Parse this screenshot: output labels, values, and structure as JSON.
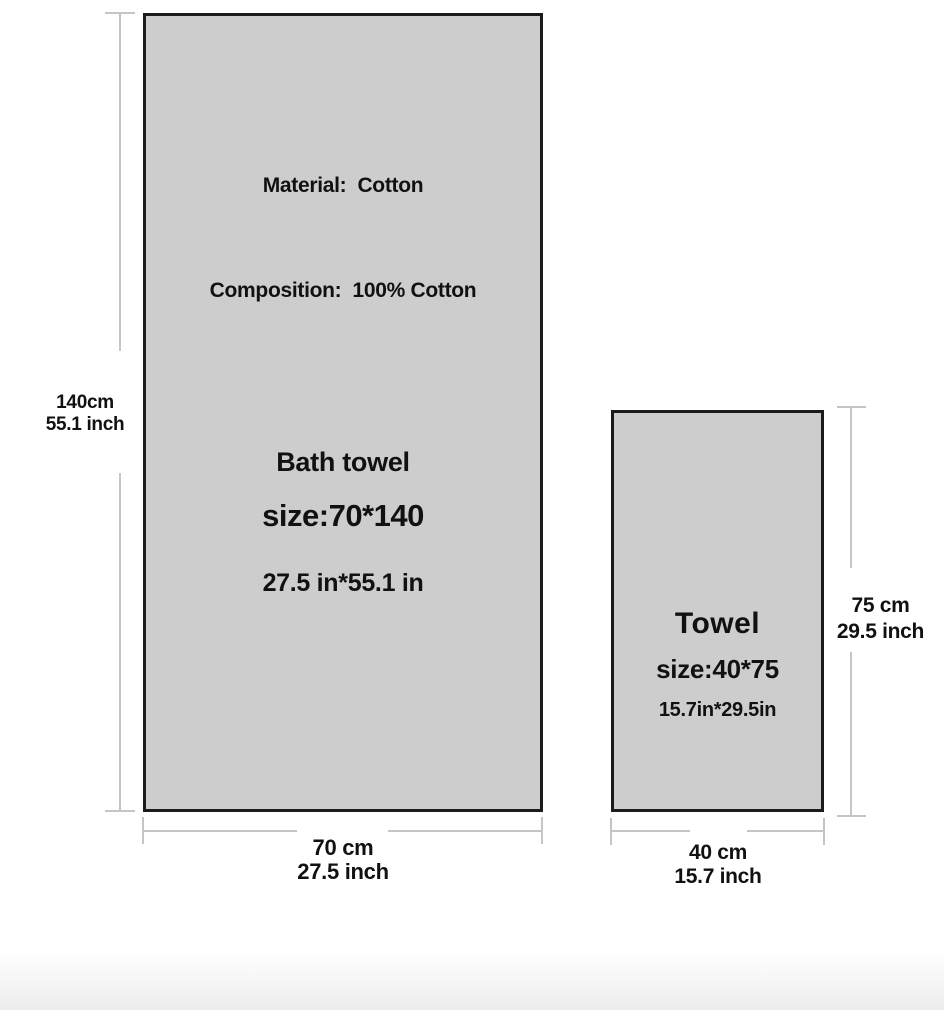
{
  "diagram": {
    "bath_towel": {
      "material_line": "Material:  Cotton",
      "composition_line": "Composition:  100% Cotton",
      "name": "Bath towel",
      "size_cm": "size:70*140",
      "size_in": "27.5 in*55.1 in",
      "height_label_cm": "140cm",
      "height_label_in": "55.1 inch",
      "width_label_cm": "70 cm",
      "width_label_in": "27.5 inch"
    },
    "hand_towel": {
      "name": "Towel",
      "size_cm": "size:40*75",
      "size_in": "15.7in*29.5in",
      "height_label_cm": "75 cm",
      "height_label_in": "29.5 inch",
      "width_label_cm": "40 cm",
      "width_label_in": "15.7 inch"
    },
    "colors": {
      "towel_fill": "#cdcdcd",
      "towel_border": "#1b1b1b",
      "dimension_line": "#c5c5c5",
      "text": "#111111"
    }
  }
}
